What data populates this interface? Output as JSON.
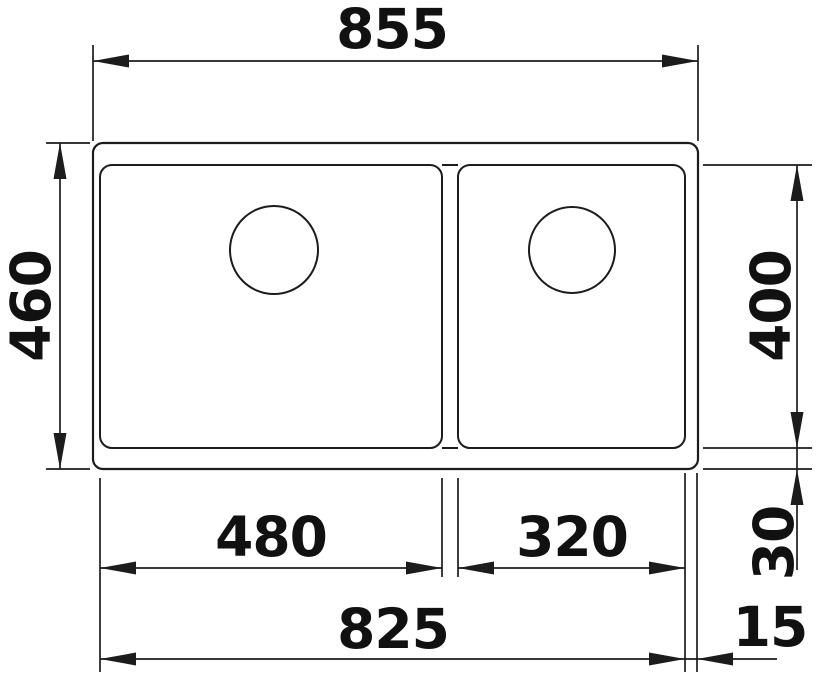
{
  "drawing": {
    "title": "sink-dimension-drawing",
    "subject": "double-bowl sink, top view with dimensions",
    "unit": "mm",
    "line_color": "#1c1c1c",
    "text_color": "#111111",
    "background": "#ffffff",
    "dimensions": {
      "overall_width": {
        "value": 855,
        "label": "855",
        "orientation": "horizontal-top"
      },
      "overall_depth": {
        "value": 460,
        "label": "460",
        "orientation": "vertical-left"
      },
      "bowl_depth": {
        "value": 400,
        "label": "400",
        "orientation": "vertical-right"
      },
      "left_bowl_width": {
        "value": 480,
        "label": "480",
        "orientation": "horizontal-bottom"
      },
      "right_bowl_width": {
        "value": 320,
        "label": "320",
        "orientation": "horizontal-bottom"
      },
      "bottom_rim_offset": {
        "value": 30,
        "label": "30",
        "orientation": "vertical-right"
      },
      "cutout_width": {
        "value": 825,
        "label": "825",
        "orientation": "horizontal-bottom"
      },
      "right_rim_offset": {
        "value": 15,
        "label": "15",
        "orientation": "horizontal-bottom"
      }
    },
    "features": {
      "bowls": 2,
      "drain_holes": 2
    }
  }
}
